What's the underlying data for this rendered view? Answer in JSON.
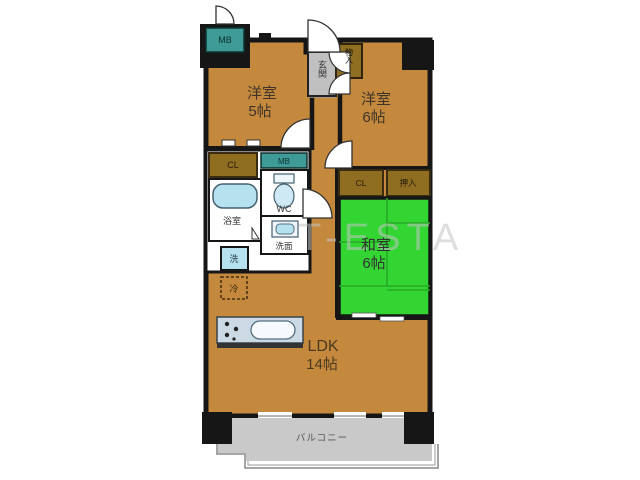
{
  "fp": {
    "watermark": "T-ESTA",
    "rooms": {
      "west5": {
        "name": "洋室",
        "size": "5帖"
      },
      "west6": {
        "name": "洋室",
        "size": "6帖"
      },
      "washitsu": {
        "name": "和室",
        "size": "6帖"
      },
      "ldk": {
        "name": "LDK",
        "size": "14帖"
      },
      "balcony": "バルコニー",
      "entrance": "玄関",
      "bath": "浴室",
      "toilet": "WC",
      "wash": "洗面"
    },
    "labels": {
      "mb_top": "MB",
      "mb_mid": "MB",
      "cl_west": "CL",
      "cl_washitsu": "CL",
      "oshiire": "押入",
      "mono_ire": "物入",
      "washer": "洗",
      "fridge": "冷"
    },
    "colors": {
      "room_fill": "#C5893E",
      "tatami_green": "#32D532",
      "closet_brown": "#8F6E22",
      "meter_box_teal": "#3E9B97",
      "fixture_blue": "#B5E2EE",
      "counter_gray": "#CBDAE4",
      "balcony_gray": "#C9C9C9",
      "genkan_gray": "#C0C0C0",
      "wall_black": "#161616"
    }
  }
}
